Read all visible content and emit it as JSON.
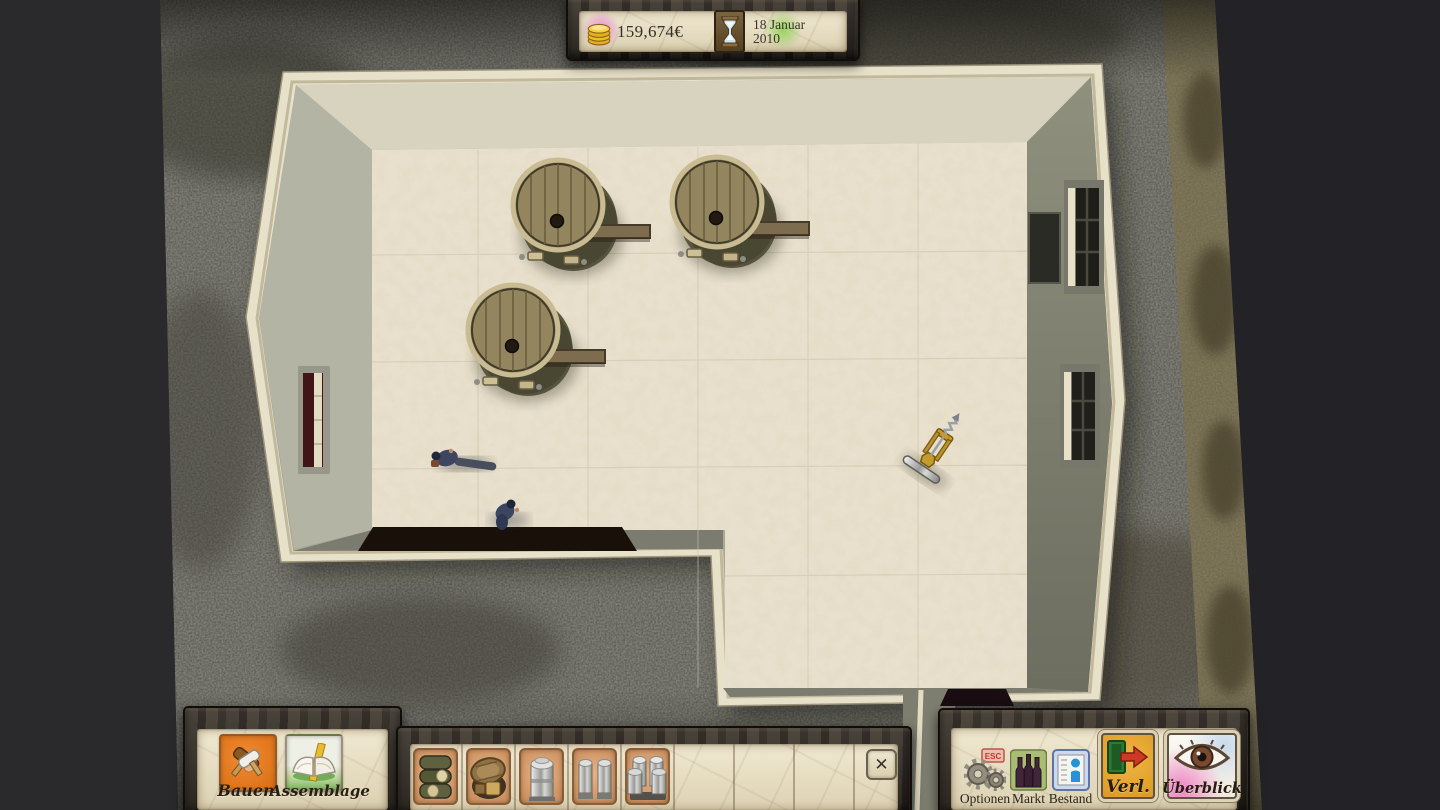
{
  "hud": {
    "money": "159,674€",
    "date_line1": "18 Januar",
    "date_line2": "2010",
    "money_icon": "gold-coins-stack",
    "date_icon": "hourglass",
    "money_glow_color": "#ec6ede",
    "date_glow_color": "#82d246"
  },
  "panels": {
    "left": {
      "buttons": [
        {
          "label": "Bauen",
          "icon": "crossed-hammers",
          "tile_color": "#e07b22"
        },
        {
          "label": "Assemblage",
          "icon": "open-book",
          "tile_color": "#8cbc6a"
        }
      ]
    },
    "build_bar": {
      "slots": [
        {
          "icon": "barrel-stack",
          "filled": true
        },
        {
          "icon": "wooden-vat",
          "filled": true
        },
        {
          "icon": "steel-tank",
          "filled": true
        },
        {
          "icon": "steel-tank-pair",
          "filled": true
        },
        {
          "icon": "steel-tank-group",
          "filled": true
        },
        {
          "icon": "",
          "filled": false
        },
        {
          "icon": "",
          "filled": false
        },
        {
          "icon": "",
          "filled": false
        }
      ],
      "close_glyph": "✕"
    },
    "right": {
      "buttons": [
        {
          "label": "Optionen",
          "icon": "gears",
          "badge": "ESC"
        },
        {
          "label": "Markt",
          "icon": "wine-bottles"
        },
        {
          "label": "Bestand",
          "icon": "info-ledger"
        },
        {
          "label": "Verl.",
          "icon": "exit-door-arrow"
        },
        {
          "label": "Überblick",
          "icon": "overview-eye"
        }
      ]
    }
  },
  "scene": {
    "description": "Top-down view of a winery cellar room with stone floor, cream wall outline and gravel surroundings",
    "objects": [
      {
        "name": "wine-barrel",
        "x": 558,
        "y": 205
      },
      {
        "name": "wine-barrel",
        "x": 717,
        "y": 202
      },
      {
        "name": "wine-barrel",
        "x": 513,
        "y": 330
      },
      {
        "name": "corkscrew-tool",
        "x": 935,
        "y": 447
      },
      {
        "name": "worker",
        "x": 447,
        "y": 458
      },
      {
        "name": "worker",
        "x": 505,
        "y": 512
      }
    ],
    "features": [
      "left-wall-window",
      "right-wall-windows-3",
      "dark-doorway-bottom-left",
      "dark-doorway-bottom-right"
    ]
  },
  "colors": {
    "parchment": "#e9e0c6",
    "wood_dark": "#2e2922",
    "floor": "#e7dfcc",
    "wall_top_border": "#e6dfc6",
    "wall_face": "#a9a997",
    "gravel": "#52514a",
    "void": "#27272a"
  }
}
